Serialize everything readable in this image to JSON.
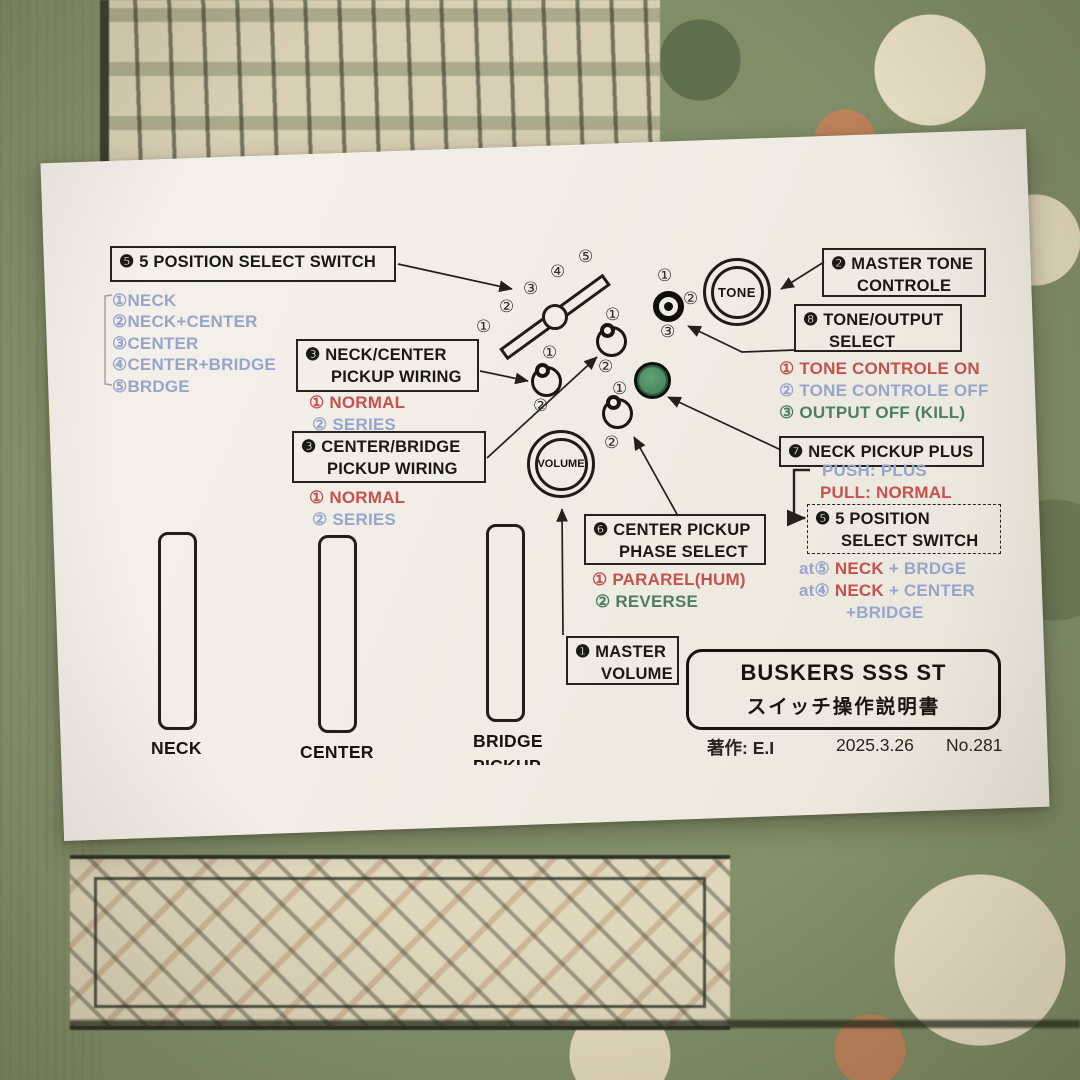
{
  "colors": {
    "red": "#c6514d",
    "blue": "#97a5cb",
    "green": "#4e7e5e",
    "ink": "#191914",
    "knob_green": "#4f9168",
    "paper": "#f0eee7"
  },
  "nums": {
    "c1": "①",
    "c2": "②",
    "c3": "③",
    "c4": "④",
    "c5": "⑤"
  },
  "boxes": {
    "switch5": {
      "badge": "❺",
      "text": "5 POSITION SELECT SWITCH"
    },
    "neck_center": {
      "badge": "❸",
      "line1": "NECK/CENTER",
      "line2": "PICKUP  WIRING"
    },
    "center_bridge": {
      "badge": "❸",
      "line1": "CENTER/BRIDGE",
      "line2": "PICKUP  WIRING"
    },
    "master_tone": {
      "badge": "❷",
      "line1": "MASTER TONE",
      "line2": "CONTROLE"
    },
    "tone_output": {
      "badge": "❽",
      "line1": "TONE/OUTPUT",
      "line2": "SELECT"
    },
    "neck_plus": {
      "badge": "❼",
      "text": "NECK PICKUP PLUS"
    },
    "center_phase": {
      "badge": "❻",
      "line1": "CENTER PICKUP",
      "line2": "PHASE  SELECT"
    },
    "master_volume": {
      "badge": "❶",
      "line1": "MASTER",
      "line2": "VOLUME"
    },
    "switch5_dashed": {
      "badge": "❺",
      "line1": "5 POSITION",
      "line2": "SELECT SWITCH"
    }
  },
  "position_list": [
    "①NECK",
    "②NECK+CENTER",
    "③CENTER",
    "④CENTER+BRIDGE",
    "⑤BRDGE"
  ],
  "wiring_options": {
    "o1": {
      "num": "①",
      "text": "NORMAL",
      "color": "red"
    },
    "o2": {
      "num": "②",
      "text": "SERIES",
      "color": "blue"
    }
  },
  "tone_output_options": [
    {
      "num": "①",
      "text": "TONE CONTROLE ON",
      "color": "red"
    },
    {
      "num": "②",
      "text": "TONE CONTROLE OFF",
      "color": "blue"
    },
    {
      "num": "③",
      "text": "OUTPUT OFF (KILL)",
      "color": "green"
    }
  ],
  "neck_plus_options": {
    "push": "PUSH: PLUS",
    "pull": "PULL:  NORMAL"
  },
  "at_lines": {
    "l1": {
      "prefix": "at⑤",
      "red": "NECK",
      "blue": "+ BRDGE"
    },
    "l2": {
      "prefix": "at④",
      "red": "NECK",
      "blue": "+ CENTER"
    },
    "l3": {
      "blue": "+BRIDGE"
    }
  },
  "phase_options": {
    "o1": {
      "num": "①",
      "text": "PARAREL(HUM)",
      "color": "red"
    },
    "o2": {
      "num": "②",
      "text": "REVERSE",
      "color": "green"
    }
  },
  "knobs": {
    "tone": "TONE",
    "volume": "VOLUME"
  },
  "pickups": {
    "neck": "NECK",
    "center": "CENTER",
    "bridge": "BRIDGE",
    "bridge2": "PICKUP"
  },
  "title_box": {
    "line1": "BUSKERS  SSS  ST",
    "line2": "スイッチ操作説明書"
  },
  "credit": {
    "author": "著作: E.I",
    "date": "2025.3.26",
    "number": "No.281"
  }
}
